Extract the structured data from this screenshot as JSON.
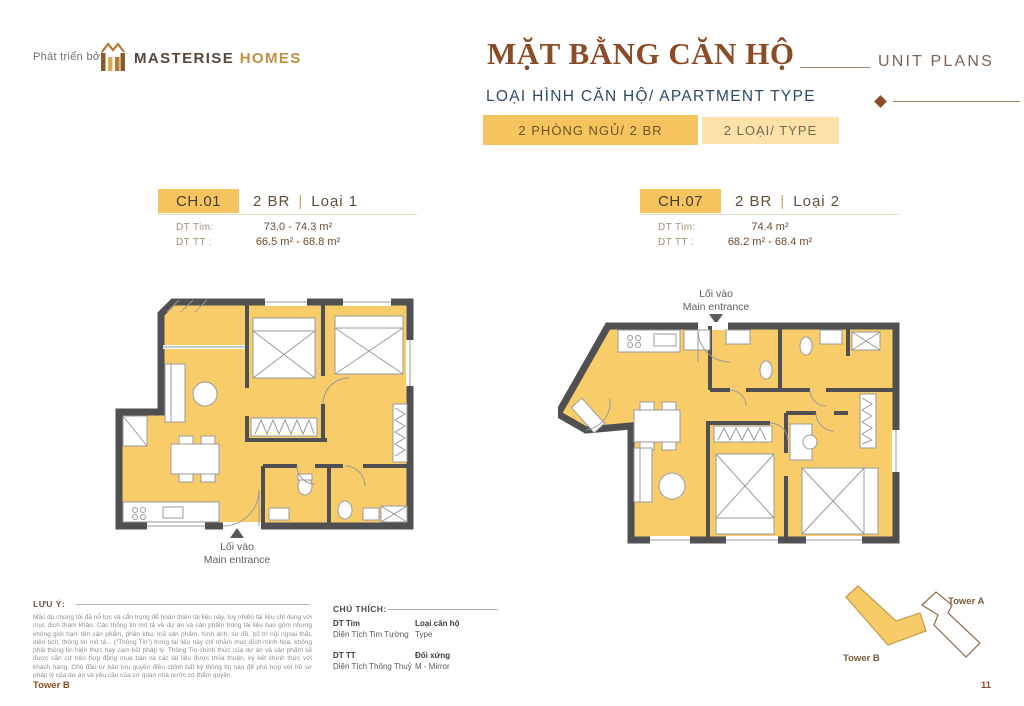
{
  "header": {
    "developed_by": "Phát triển bởi",
    "brand_primary": "MASTERISE",
    "brand_secondary": "HOMES",
    "title_vi": "MẶT BẰNG CĂN HỘ",
    "title_en": "UNIT PLANS",
    "subtitle": "LOẠI HÌNH CĂN HỘ/ APARTMENT TYPE",
    "tabs": [
      {
        "label": "2 PHÒNG NGỦ/ 2 BR",
        "active": true
      },
      {
        "label": "2 LOẠI/ TYPE",
        "active": false
      }
    ]
  },
  "units": [
    {
      "code": "CH.01",
      "bedrooms": "2 BR",
      "variant": "Loại 1",
      "area_tim_label": "DT Tim:",
      "area_tim": "73.0 - 74.3 m²",
      "area_tt_label": "DT TT :",
      "area_tt": "66.5 m² - 68.8 m²",
      "entrance_vi": "Lối vào",
      "entrance_en": "Main entrance"
    },
    {
      "code": "CH.07",
      "bedrooms": "2 BR",
      "variant": "Loại 2",
      "area_tim_label": "DT Tim:",
      "area_tim": "74.4 m²",
      "area_tt_label": "DT TT :",
      "area_tt": "68.2 m² - 68.4 m²",
      "entrance_vi": "Lối vào",
      "entrance_en": "Main entrance"
    }
  ],
  "notes": {
    "label": "LƯU Ý:",
    "body": "Mặc dù chúng tôi đã nỗ lực và cẩn trọng để hoàn thiện tài liệu này, tuy nhiên tài liệu chỉ dùng với mục đích tham khảo. Các thông tin mô tả về dự án và sản phẩm trong tài liệu bao gồm nhưng không giới hạn: tên sản phẩm, phân khu, mã sản phẩm, hình ảnh, sơ đồ, bố trí nội ngoại thất, diện tích, thông tin mô tả... (\"Thông Tin\") trong tài liệu này chỉ nhằm mục đích minh họa, không phải thông tin hiện thực hay cam kết pháp lý. Thông Tin chính thức của dự án và sản phẩm sẽ được căn cứ trên hợp đồng mua bán và các tài liệu được thỏa thuận, ký kết chính thức với khách hàng. Chủ đầu tư bảo lưu quyền điều chỉnh bất kỳ thông tin nào để phù hợp với hồ sơ pháp lý của dự án và yêu cầu của cơ quan nhà nước có thẩm quyền."
  },
  "legend": {
    "label": "CHÚ THÍCH:",
    "items": [
      {
        "term": "DT Tim",
        "definition": "Diện Tích Tim Tường"
      },
      {
        "term": "Loại căn hộ",
        "definition": "Type"
      },
      {
        "term": "DT TT",
        "definition": "Diện Tích Thông Thuỷ"
      },
      {
        "term": "Đối xứng",
        "definition": "M - Mirror"
      }
    ]
  },
  "site_plan": {
    "tower_a": "Tower A",
    "tower_b": "Tower B"
  },
  "footer": {
    "tower": "Tower B",
    "page_number": "11"
  },
  "colors": {
    "gold": "#F5C45F",
    "gold_light": "#FBE2A9",
    "plan_fill": "#F8CC69",
    "wall": "#505053",
    "title_brown": "#8B4B26",
    "navy": "#2F4A67"
  }
}
